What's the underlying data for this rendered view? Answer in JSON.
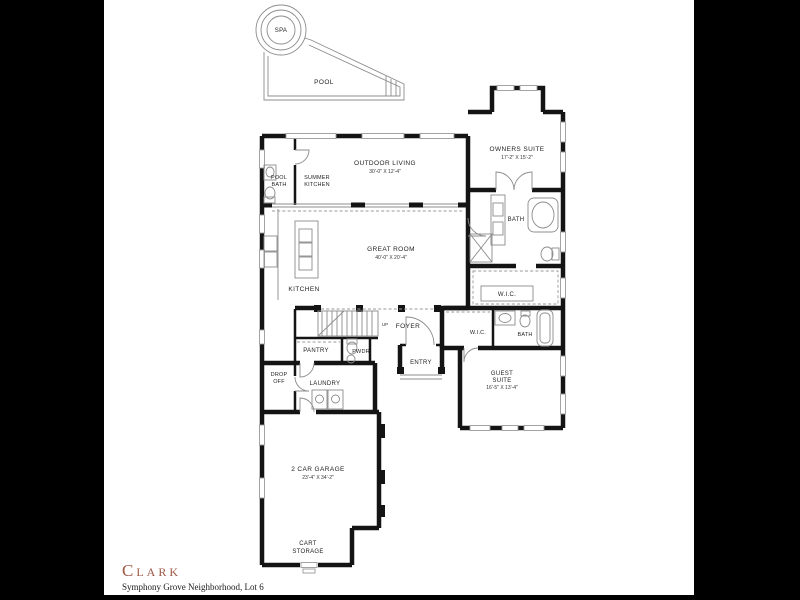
{
  "brand": {
    "name": "Clark",
    "subtitle": "Symphony Grove Neighborhood, Lot 6"
  },
  "labels": {
    "spa": "SPA",
    "pool": "POOL",
    "pool_bath_1": "POOL",
    "pool_bath_2": "BATH",
    "summer_kitchen_1": "SUMMER",
    "summer_kitchen_2": "KITCHEN",
    "outdoor_living": "OUTDOOR LIVING",
    "outdoor_living_dims": "30'-0\" X 12'-4\"",
    "owners_suite": "OWNERS SUITE",
    "owners_suite_dims": "17'-2\" X 15'-2\"",
    "owners_bath": "BATH",
    "owners_wic": "W.I.C.",
    "great_room": "GREAT ROOM",
    "great_room_dims": "40'-0\" X 20'-4\"",
    "kitchen": "KITCHEN",
    "pantry": "PANTRY",
    "powder": "PWDR",
    "foyer": "FOYER",
    "stairs_up": "UP",
    "entry": "ENTRY",
    "guest_wic": "W.I.C.",
    "guest_bath": "BATH",
    "guest_suite_1": "GUEST",
    "guest_suite_2": "SUITE",
    "guest_suite_dims": "16'-5\" X 13'-4\"",
    "drop_off_1": "DROP",
    "drop_off_2": "OFF",
    "laundry": "LAUNDRY",
    "garage": "2 CAR GARAGE",
    "garage_dims": "23'-4\" X 34'-2\"",
    "cart_storage_1": "CART",
    "cart_storage_2": "STORAGE"
  },
  "colors": {
    "background": "#000000",
    "page": "#ffffff",
    "walls": "#141414",
    "thin_line": "#8c8c8c",
    "label_text": "#1f1f1f",
    "brand_accent": "#9c5744"
  }
}
